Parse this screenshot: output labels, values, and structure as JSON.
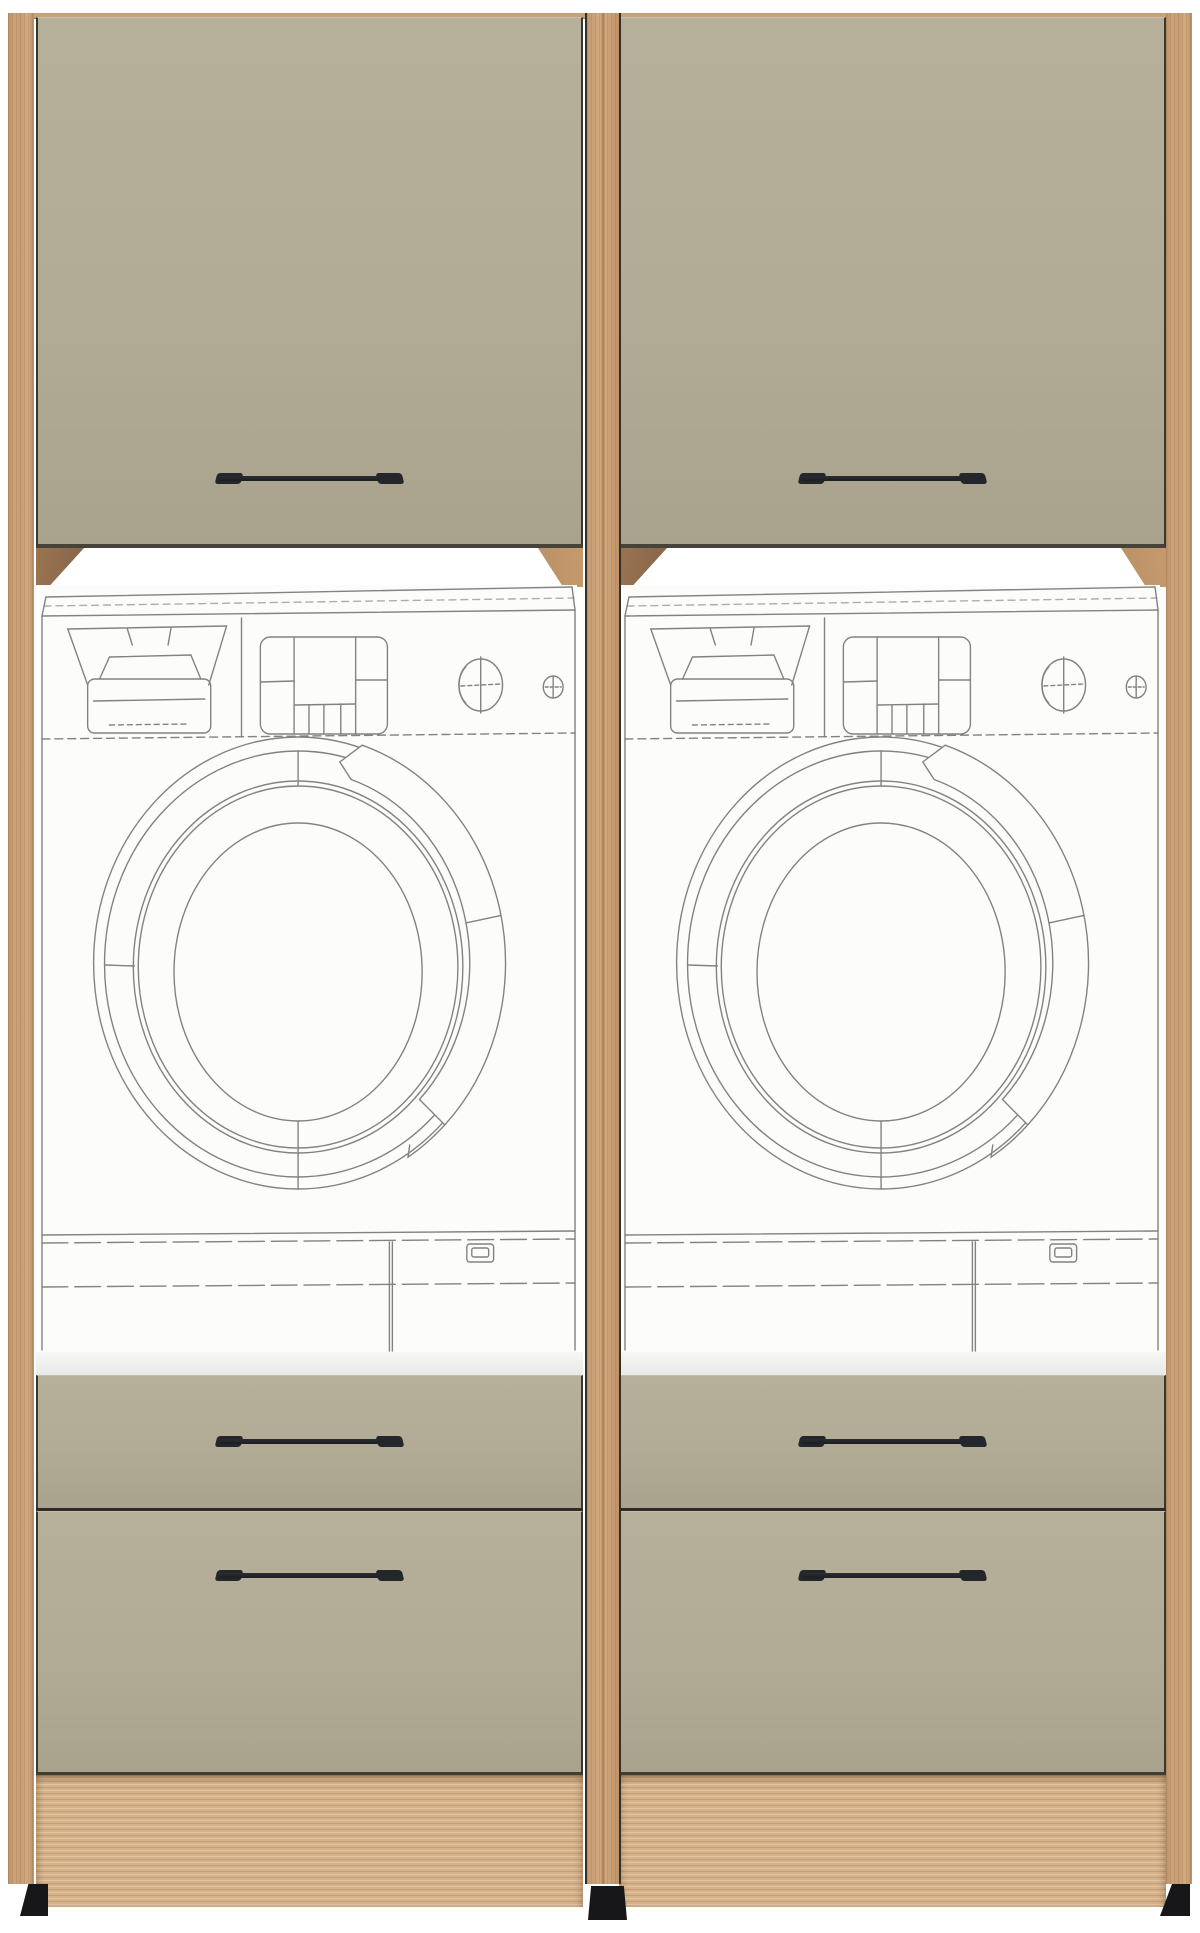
{
  "scene": {
    "kind": "laundry-cabinet-product-render",
    "tower_count": 2,
    "handles_per_tower": 3,
    "appliance": "washing-machine-wireframe"
  },
  "palette": {
    "background": "#ffffff",
    "front": "#b2ac96",
    "front_edge": "#393731",
    "drawer_gap": "#2e2c25",
    "wood_frame": "#c9a077",
    "wood_plinth": "#d5b28a",
    "wood_inner_shadow": "#9a7450",
    "wood_wedge": "#c59a6d",
    "handle": "#1b1d21",
    "handle_cap": "#23262b",
    "appliance_bg": "#fcfcfb",
    "appliance_line": "#82827f",
    "shelf_top": "#f6f6f4",
    "shelf_bottom": "#e9e9e7",
    "foot": "#17171a"
  },
  "units": [
    {
      "id": "tower-left",
      "parts": [
        "wall-cabinet-door",
        "washing-machine-wireframe",
        "appliance-shelf",
        "drawer-front-small",
        "drawer-front-large",
        "toe-kick-panel"
      ]
    },
    {
      "id": "tower-right",
      "parts": [
        "wall-cabinet-door",
        "washing-machine-wireframe",
        "appliance-shelf",
        "drawer-front-small",
        "drawer-front-large",
        "toe-kick-panel"
      ]
    }
  ]
}
